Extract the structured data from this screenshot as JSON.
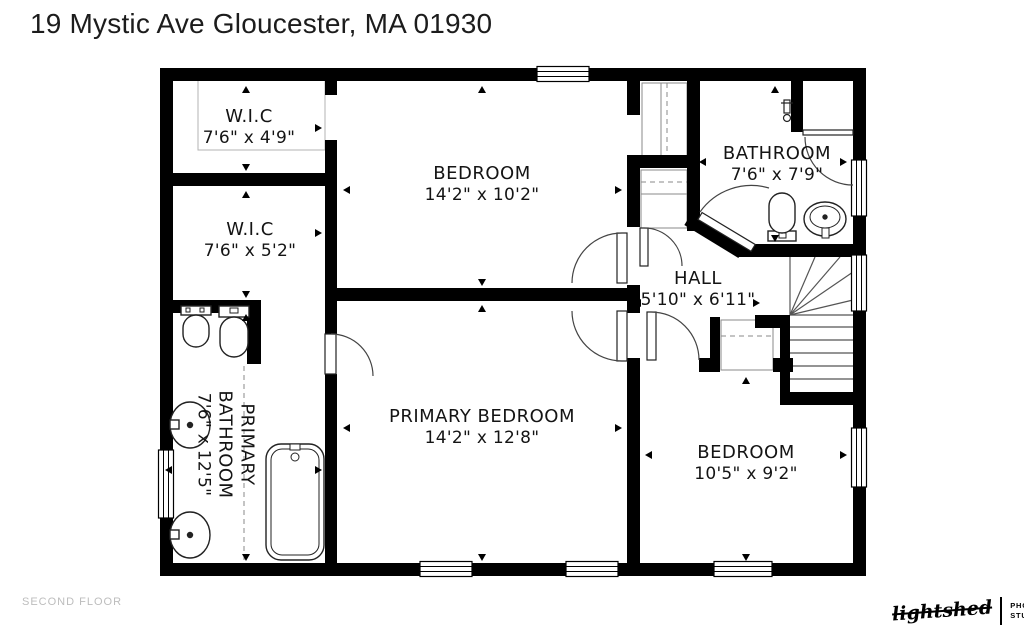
{
  "header": {
    "title": "19 Mystic Ave Gloucester, MA 01930"
  },
  "floor_label": "SECOND FLOOR",
  "logo": {
    "name": "lightshed",
    "line1": "PHOTOGRAPHY",
    "line2": "STUDIO"
  },
  "rooms": [
    {
      "id": "wic-top",
      "name": "W.I.C",
      "dimensions": "7'6\" x 4'9\""
    },
    {
      "id": "wic-middle",
      "name": "W.I.C",
      "dimensions": "7'6\" x 5'2\""
    },
    {
      "id": "bedroom-top",
      "name": "BEDROOM",
      "dimensions": "14'2\" x 10'2\""
    },
    {
      "id": "bathroom",
      "name": "BATHROOM",
      "dimensions": "7'6\" x 7'9\""
    },
    {
      "id": "hall",
      "name": "HALL",
      "dimensions": "5'10\" x 6'11\""
    },
    {
      "id": "primary-bathroom",
      "name": "PRIMARY BATHROOM",
      "dimensions": "7'6\" x 12'5\""
    },
    {
      "id": "primary-bedroom",
      "name": "PRIMARY BEDROOM",
      "dimensions": "14'2\" x 12'8\""
    },
    {
      "id": "bedroom-bottom",
      "name": "BEDROOM",
      "dimensions": "10'5\" x 9'2\""
    }
  ],
  "colors": {
    "wall": "#000000",
    "background": "#ffffff",
    "label_text": "#141414",
    "muted_text": "#bdbdbd"
  }
}
